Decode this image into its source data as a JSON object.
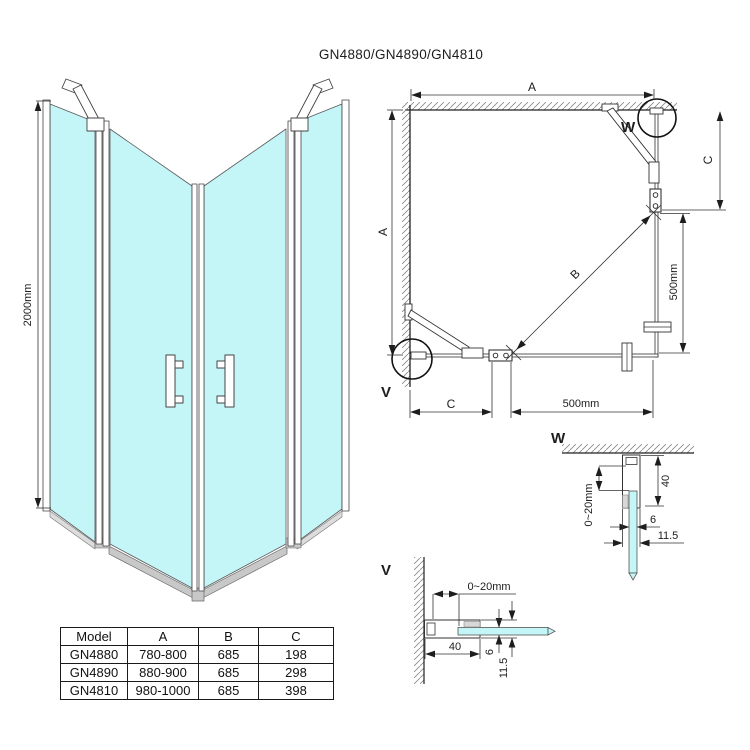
{
  "title": "GN4880/GN4890/GN4810",
  "colors": {
    "glass": "#c4f5f7",
    "rail": "#c8c8c8",
    "line": "#222222"
  },
  "front_view": {
    "height_dim": "2000mm"
  },
  "plan_view": {
    "dim_a_top": "A",
    "dim_a_left": "A",
    "dim_c_right": "C",
    "dim_c_bottom": "C",
    "dim_b_diagonal": "B",
    "dim_500_right": "500mm",
    "dim_500_bottom": "500mm",
    "marker_w": "W",
    "marker_v": "V"
  },
  "detail_w": {
    "title": "W",
    "dim_gap": "0~20mm",
    "dim_depth": "40",
    "dim_glass": "6",
    "dim_profile": "11.5"
  },
  "detail_v": {
    "title": "V",
    "dim_gap": "0~20mm",
    "dim_depth": "40",
    "dim_glass": "6",
    "dim_profile": "11.5"
  },
  "table": {
    "headers": [
      "Model",
      "A",
      "B",
      "C"
    ],
    "rows": [
      {
        "model": "GN4880",
        "a": "780-800",
        "b": "685",
        "c": "198"
      },
      {
        "model": "GN4890",
        "a": "880-900",
        "b": "685",
        "c": "298"
      },
      {
        "model": "GN4810",
        "a": "980-1000",
        "b": "685",
        "c": "398"
      }
    ]
  }
}
